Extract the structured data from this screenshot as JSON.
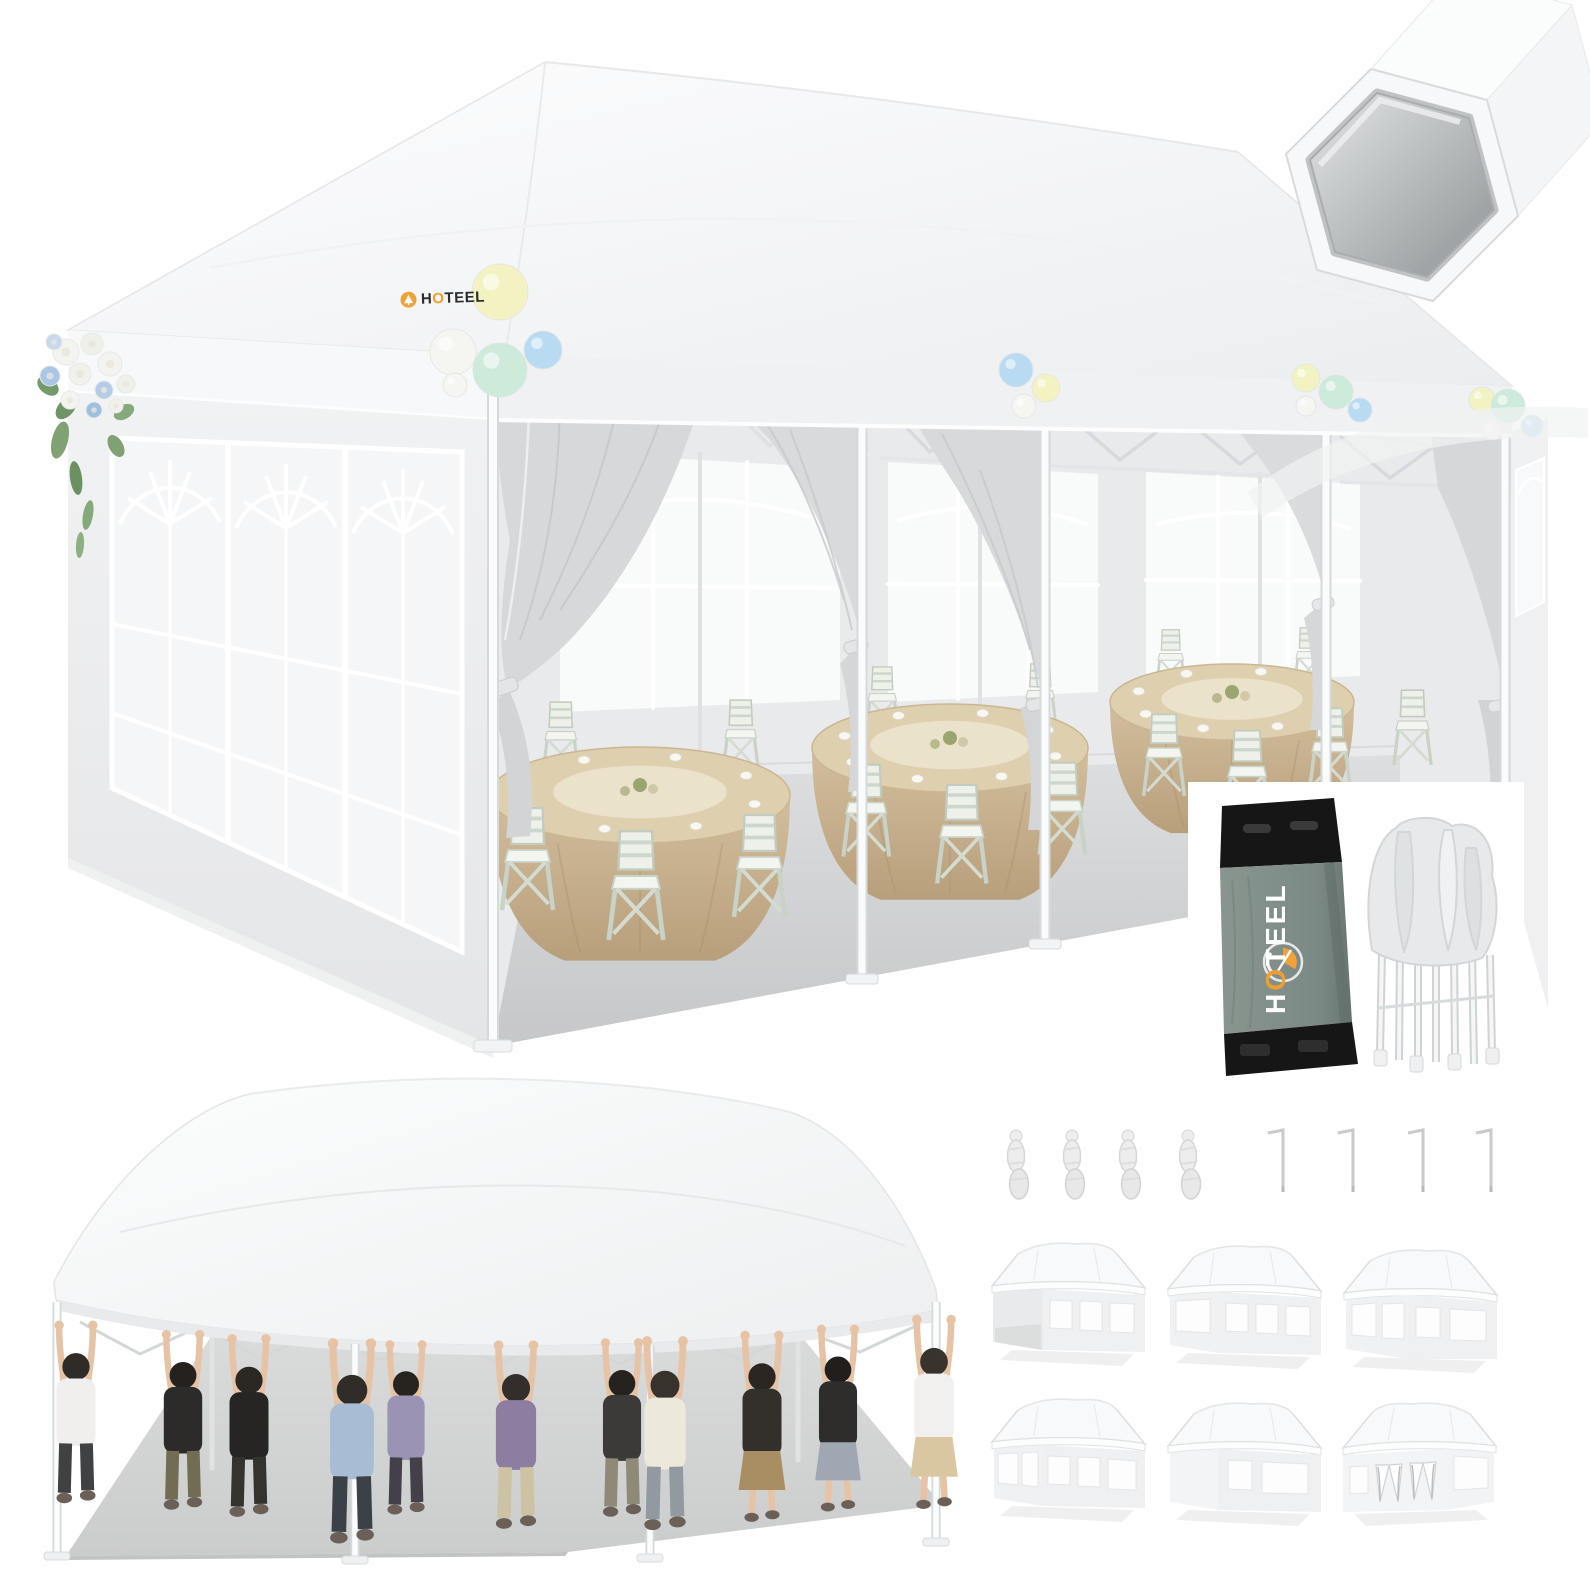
{
  "brand": {
    "name": "HOTEEL",
    "accent": "#f09e30",
    "tent_logo_text_color": "#2b2b2b",
    "bag_logo_text_color": "#ffffff"
  },
  "palette": {
    "canopy_white": "#fbfcfd",
    "canopy_shade": "#edeff1",
    "wall_gray": "#ededef",
    "curtain_gray": "#d6d8da",
    "floor_gray": "#cdcecf",
    "tablecloth_tan": "#c9b18e",
    "chair_green_white": "#edf1ea",
    "bag_gray": "#7e8b88",
    "bag_black": "#161616",
    "yellow": "#f2f2c3",
    "mint": "#cdebdb",
    "blue": "#b9dbf2",
    "white": "#f5f6f1"
  },
  "main_scene": {
    "balloon_clusters": [
      {
        "name": "corner-large",
        "balloons": [
          {
            "x": 500,
            "y": 292,
            "r": 28,
            "c": "yellow"
          },
          {
            "x": 453,
            "y": 352,
            "r": 23,
            "c": "white"
          },
          {
            "x": 500,
            "y": 370,
            "r": 27,
            "c": "mint"
          },
          {
            "x": 543,
            "y": 350,
            "r": 19,
            "c": "blue"
          },
          {
            "x": 455,
            "y": 385,
            "r": 12,
            "c": "white"
          }
        ]
      },
      {
        "name": "mid-1",
        "balloons": [
          {
            "x": 1016,
            "y": 370,
            "r": 17,
            "c": "blue"
          },
          {
            "x": 1046,
            "y": 388,
            "r": 14,
            "c": "yellow"
          },
          {
            "x": 1024,
            "y": 406,
            "r": 12,
            "c": "white"
          }
        ]
      },
      {
        "name": "mid-2",
        "balloons": [
          {
            "x": 1306,
            "y": 378,
            "r": 14,
            "c": "yellow"
          },
          {
            "x": 1336,
            "y": 392,
            "r": 17,
            "c": "mint"
          },
          {
            "x": 1360,
            "y": 410,
            "r": 12,
            "c": "blue"
          },
          {
            "x": 1306,
            "y": 406,
            "r": 10,
            "c": "white"
          }
        ]
      },
      {
        "name": "right-corner",
        "balloons": [
          {
            "x": 1482,
            "y": 400,
            "r": 13,
            "c": "yellow"
          },
          {
            "x": 1508,
            "y": 406,
            "r": 17,
            "c": "mint"
          },
          {
            "x": 1532,
            "y": 426,
            "r": 11,
            "c": "blue"
          },
          {
            "x": 1492,
            "y": 430,
            "r": 10,
            "c": "white"
          }
        ]
      }
    ],
    "flowers": {
      "leaves": [
        {
          "x": 60,
          "y": 440,
          "rx": 8,
          "ry": 19,
          "rot": 14,
          "c": "#7fa174"
        },
        {
          "x": 76,
          "y": 478,
          "rx": 6,
          "ry": 17,
          "rot": -8,
          "c": "#6b9163"
        },
        {
          "x": 88,
          "y": 515,
          "rx": 5,
          "ry": 15,
          "rot": 10,
          "c": "#85a97b"
        },
        {
          "x": 66,
          "y": 408,
          "rx": 8,
          "ry": 13,
          "rot": 40,
          "c": "#6f9566"
        },
        {
          "x": 116,
          "y": 446,
          "rx": 7,
          "ry": 12,
          "rot": -30,
          "c": "#7fa174"
        },
        {
          "x": 48,
          "y": 386,
          "rx": 8,
          "ry": 12,
          "rot": -52,
          "c": "#74996b"
        },
        {
          "x": 124,
          "y": 412,
          "rx": 7,
          "ry": 11,
          "rot": 60,
          "c": "#85a97b"
        },
        {
          "x": 80,
          "y": 545,
          "rx": 4,
          "ry": 13,
          "rot": 4,
          "c": "#8db083"
        }
      ],
      "blooms": [
        {
          "x": 66,
          "y": 352,
          "r": 13,
          "c": "#f3f4f0"
        },
        {
          "x": 92,
          "y": 344,
          "r": 11,
          "c": "#eef0ea"
        },
        {
          "x": 110,
          "y": 364,
          "r": 12,
          "c": "#f3f4f0"
        },
        {
          "x": 50,
          "y": 376,
          "r": 10,
          "c": "#a9c6e6"
        },
        {
          "x": 80,
          "y": 374,
          "r": 11,
          "c": "#f0f1ec"
        },
        {
          "x": 104,
          "y": 390,
          "r": 9,
          "c": "#b3cce8"
        },
        {
          "x": 126,
          "y": 384,
          "r": 9,
          "c": "#eef0ea"
        },
        {
          "x": 70,
          "y": 400,
          "r": 9,
          "c": "#f3f4f0"
        },
        {
          "x": 94,
          "y": 410,
          "r": 8,
          "c": "#9fbfe2"
        },
        {
          "x": 116,
          "y": 406,
          "r": 7,
          "c": "#f0f1ec"
        },
        {
          "x": 54,
          "y": 342,
          "r": 8,
          "c": "#c7d9ee"
        }
      ]
    },
    "tables": [
      {
        "cx": 640,
        "cy": 795,
        "rx": 150,
        "ry": 48
      },
      {
        "cx": 950,
        "cy": 748,
        "rx": 138,
        "ry": 44
      },
      {
        "cx": 1232,
        "cy": 702,
        "rx": 122,
        "ry": 38
      }
    ],
    "chairs_back": [
      {
        "x": 545,
        "y": 700,
        "s": 1.05
      },
      {
        "x": 725,
        "y": 698,
        "s": 1.05
      },
      {
        "x": 868,
        "y": 665,
        "s": 0.95
      },
      {
        "x": 1026,
        "y": 662,
        "s": 0.95
      },
      {
        "x": 1158,
        "y": 628,
        "s": 0.85
      },
      {
        "x": 1296,
        "y": 626,
        "s": 0.85
      }
    ],
    "chairs_front": [
      {
        "x": 505,
        "y": 805,
        "s": 1.5
      },
      {
        "x": 612,
        "y": 828,
        "s": 1.6
      },
      {
        "x": 737,
        "y": 812,
        "s": 1.5
      },
      {
        "x": 846,
        "y": 762,
        "s": 1.35
      },
      {
        "x": 940,
        "y": 782,
        "s": 1.45
      },
      {
        "x": 1042,
        "y": 760,
        "s": 1.35
      },
      {
        "x": 1146,
        "y": 712,
        "s": 1.2
      },
      {
        "x": 1228,
        "y": 728,
        "s": 1.28
      },
      {
        "x": 1312,
        "y": 706,
        "s": 1.2
      },
      {
        "x": 1396,
        "y": 688,
        "s": 1.1
      }
    ]
  },
  "strength_demo": {
    "people": [
      {
        "x": 76,
        "s": 1.3,
        "shirt": "#f0efed",
        "pants": "#3f4143",
        "hair": "#2f2b27",
        "skirt": false
      },
      {
        "x": 183,
        "s": 1.28,
        "shirt": "#2c2b29",
        "pants": "#716d52",
        "hair": "#24211e",
        "skirt": false
      },
      {
        "x": 249,
        "s": 1.3,
        "shirt": "#262524",
        "pants": "#35332f",
        "hair": "#2b2723",
        "skirt": false
      },
      {
        "x": 352,
        "s": 1.46,
        "shirt": "#a8bdd3",
        "pants": "#3c4148",
        "hair": "#302c28",
        "skirt": false
      },
      {
        "x": 406,
        "s": 1.24,
        "shirt": "#9b93b4",
        "pants": "#43404a",
        "hair": "#27231f",
        "skirt": false
      },
      {
        "x": 516,
        "s": 1.34,
        "shirt": "#8d7da1",
        "pants": "#cec2a4",
        "hair": "#332e29",
        "skirt": false
      },
      {
        "x": 622,
        "s": 1.27,
        "shirt": "#3b3a38",
        "pants": "#8e8a77",
        "hair": "#26221e",
        "skirt": false
      },
      {
        "x": 665,
        "s": 1.38,
        "shirt": "#ece9dc",
        "pants": "#9299a1",
        "hair": "#37322c",
        "skirt": false
      },
      {
        "x": 762,
        "s": 1.3,
        "shirt": "#33302c",
        "pants": "#a98e63",
        "hair": "#2b2622",
        "skirt": true
      },
      {
        "x": 838,
        "s": 1.27,
        "shirt": "#2e2d2c",
        "pants": "#9fa8b2",
        "hair": "#211e1b",
        "skirt": true
      },
      {
        "x": 934,
        "s": 1.32,
        "shirt": "#f1f0ee",
        "pants": "#d8c7a0",
        "hair": "#38332d",
        "skirt": true
      }
    ]
  },
  "accessories": {
    "ropes": [
      {
        "x": 1016
      },
      {
        "x": 1072
      },
      {
        "x": 1128
      },
      {
        "x": 1188
      }
    ],
    "stakes": [
      {
        "x": 1268
      },
      {
        "x": 1338
      },
      {
        "x": 1408
      },
      {
        "x": 1476
      }
    ]
  },
  "variants": [
    {
      "x": 982,
      "y": 1228,
      "type": "open-end",
      "mirror": false
    },
    {
      "x": 1158,
      "y": 1231,
      "type": "enclosed",
      "mirror": false
    },
    {
      "x": 1334,
      "y": 1235,
      "type": "enclosed-b",
      "mirror": false
    },
    {
      "x": 982,
      "y": 1384,
      "type": "windows-all",
      "mirror": false
    },
    {
      "x": 1158,
      "y": 1388,
      "type": "solid-end",
      "mirror": false
    },
    {
      "x": 1334,
      "y": 1388,
      "type": "curtain-doors",
      "mirror": true
    }
  ]
}
